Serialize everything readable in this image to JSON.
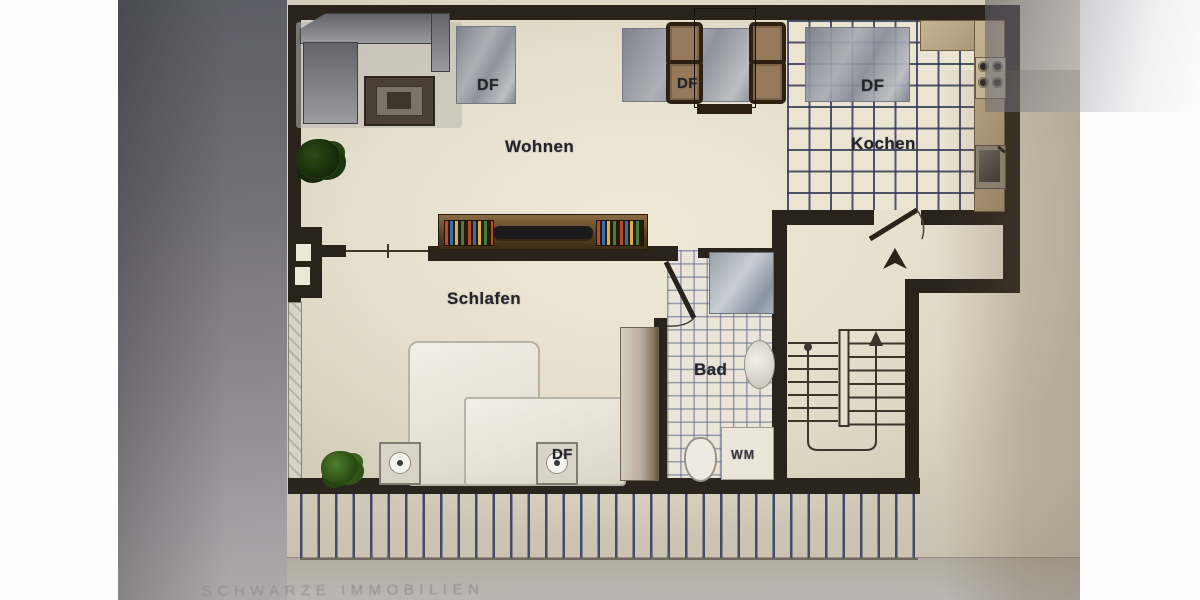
{
  "photo": {
    "watermark": "SCHWARZE IMMOBILIEN"
  },
  "floorplan": {
    "rooms": {
      "living": {
        "label": "Wohnen"
      },
      "kitchen": {
        "label": "Kochen"
      },
      "bedroom": {
        "label": "Schlafen"
      },
      "bath": {
        "label": "Bad"
      }
    },
    "skylights": {
      "living": "DF",
      "dining": "DF",
      "kitchen": "DF",
      "bedroom": "DF"
    },
    "appliances": {
      "washing_machine": "WM"
    },
    "colors": {
      "sheet": "#e8e1cf",
      "wall": "#29231c",
      "tile_line": "#323a56",
      "hatch_line": "#3d476b",
      "counter": "#b7a483",
      "skylight_grey": "#9196a1",
      "wood_dark": "#3c2c14",
      "plant_green": "#4f7d2c",
      "label_text": "#23232a"
    }
  }
}
